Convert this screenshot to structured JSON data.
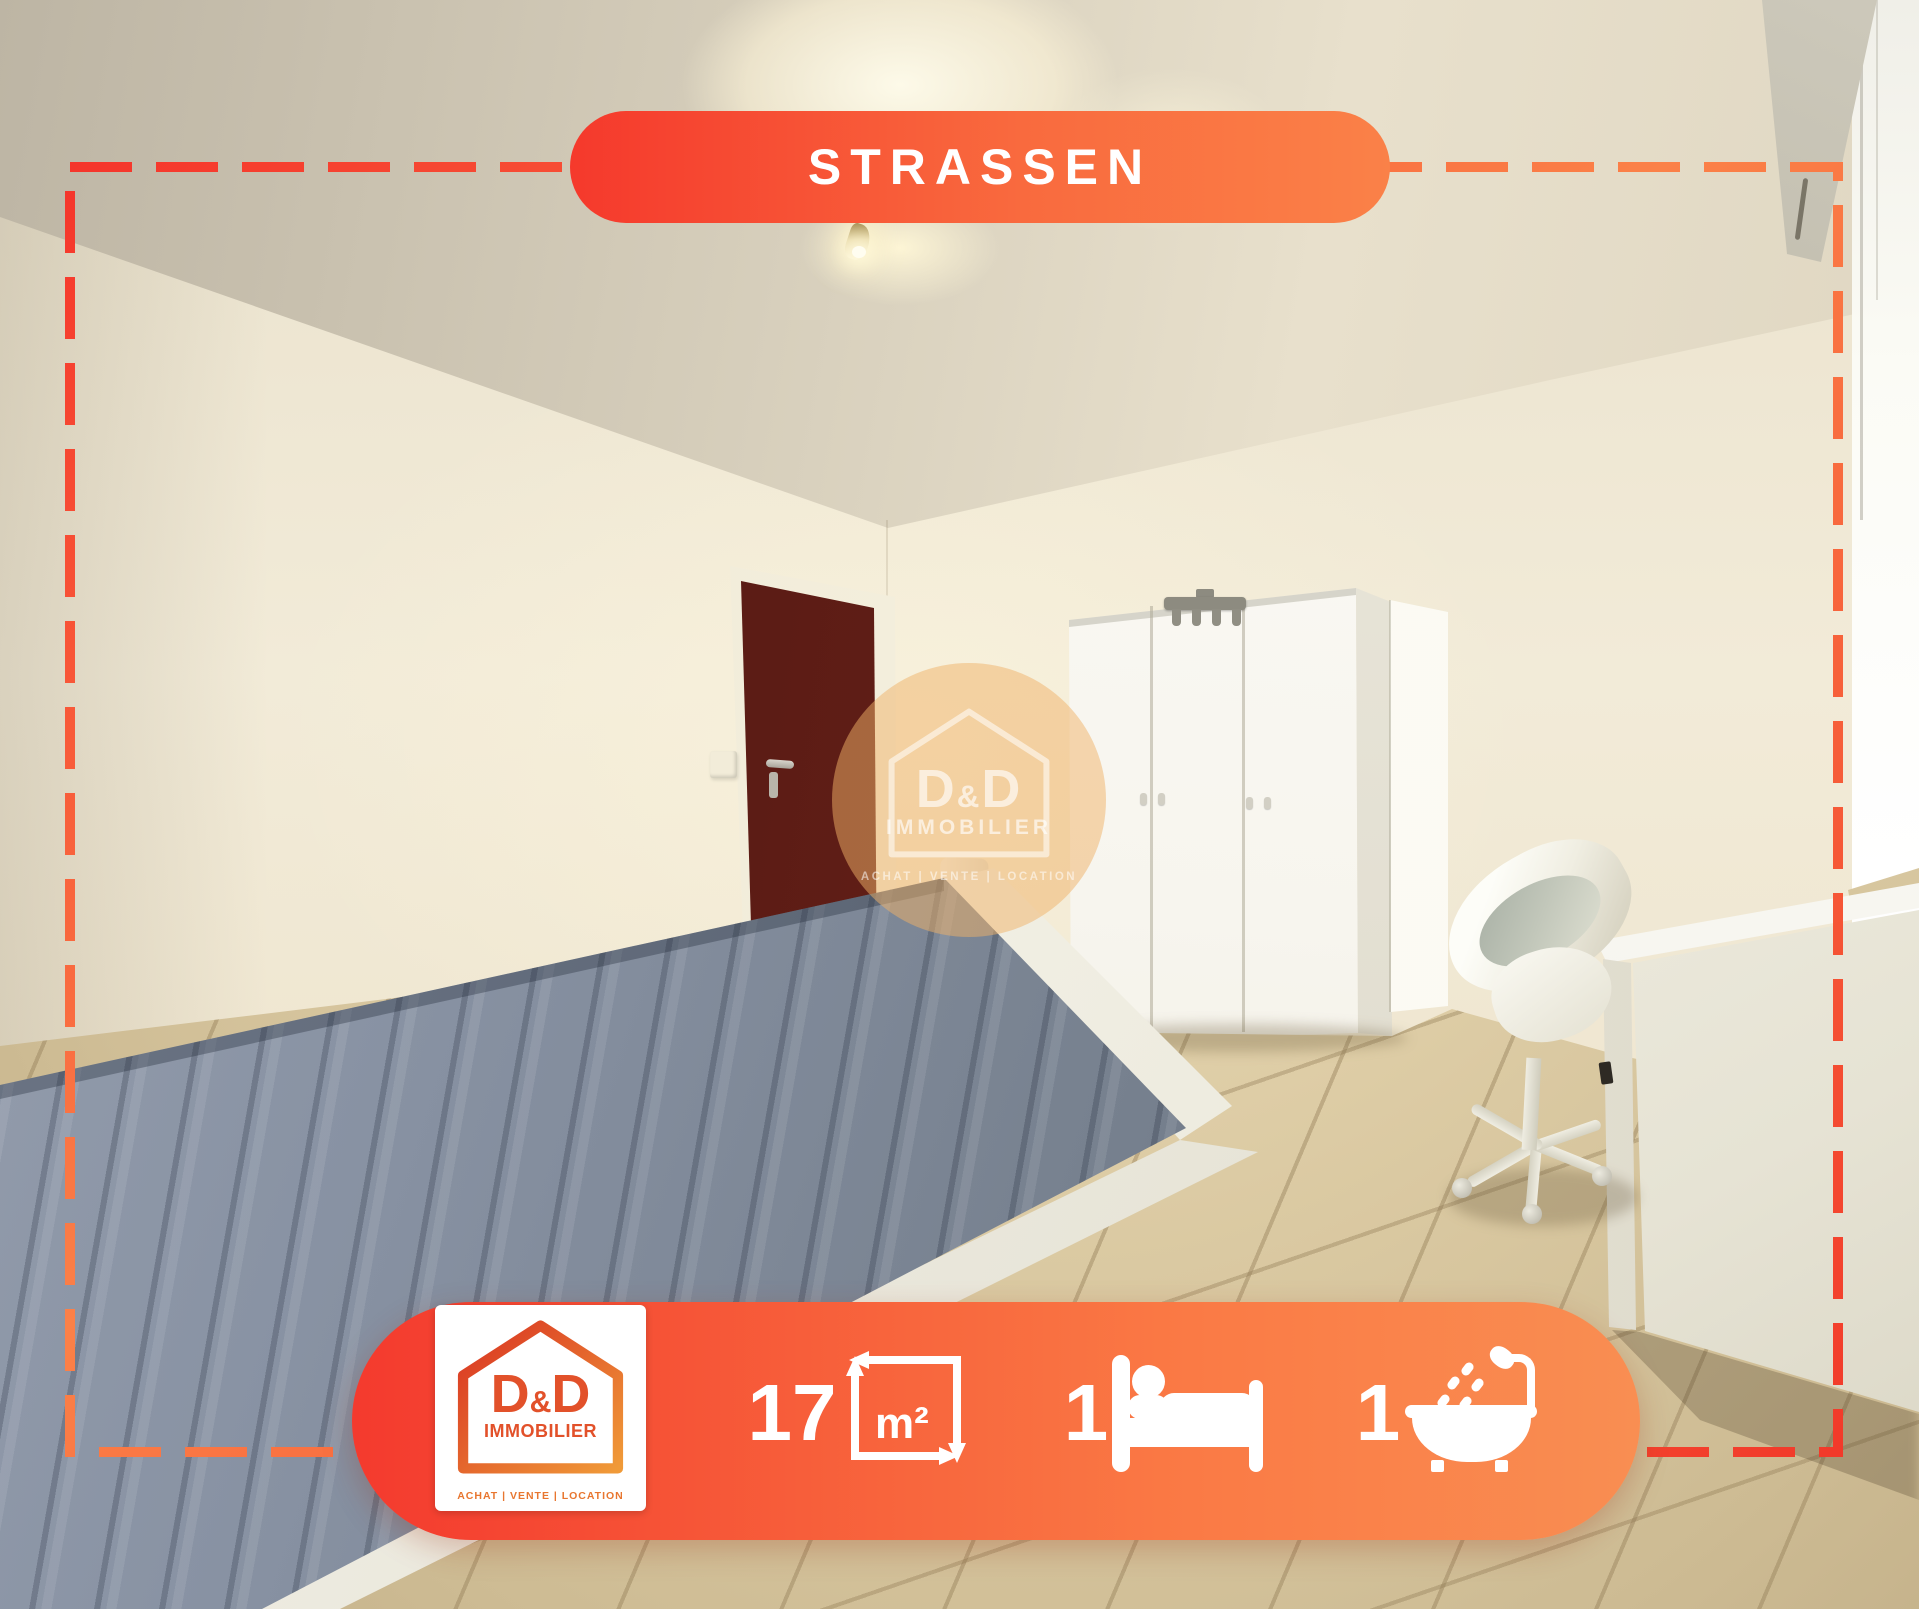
{
  "location_banner": {
    "label": "STRASSEN"
  },
  "stats": {
    "area_value": "17",
    "area_unit": "m²",
    "bedrooms": "1",
    "bathrooms": "1"
  },
  "agency_card": {
    "brand_d1": "D",
    "brand_amp": "&",
    "brand_d2": "D",
    "division": "IMMOBILIER",
    "tagline": "ACHAT | VENTE | LOCATION"
  },
  "watermark": {
    "brand_d1": "D",
    "brand_amp": "&",
    "brand_d2": "D",
    "division": "IMMOBILIER",
    "tagline": "ACHAT | VENTE | LOCATION"
  },
  "scene": {
    "description": "bedroom with blue-gray quilted mattress, dark red door, white three-door wardrobe with hook rack, white desk and shell chair, beige tiled floor, bright window on right"
  },
  "colors": {
    "accent_red": "#f5392c",
    "accent_orange": "#fa8148",
    "logo_orange": "#e2512a",
    "logo_red": "#d93322",
    "logo_gold": "#f09a38",
    "tagline_orange": "#e8762f",
    "door_maroon": "#5e1d16",
    "mattress_blue": "#7e8898",
    "floor_beige": "#dbcba6",
    "wall_cream": "#f0e8d4"
  }
}
